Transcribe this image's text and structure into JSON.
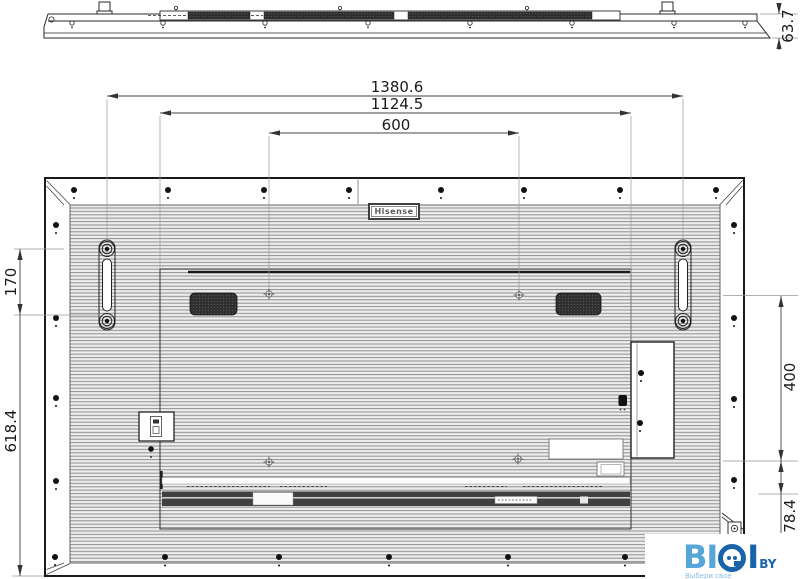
{
  "dimensions": {
    "top_width": "1380.6",
    "mid_width": "1124.5",
    "vesa_width": "600",
    "depth": "63.7",
    "handle_pitch": "170",
    "left_height": "618.4",
    "vesa_height": "400",
    "bottom_offset": "78.4"
  },
  "labels": {
    "brand": "Hisense"
  },
  "watermark": {
    "word_light": "BI",
    "word_dark_i": "I",
    "word_suffix": "BY",
    "tagline": "Выбери своё",
    "color_light": "#56a6da",
    "color_dark": "#1864ab"
  }
}
